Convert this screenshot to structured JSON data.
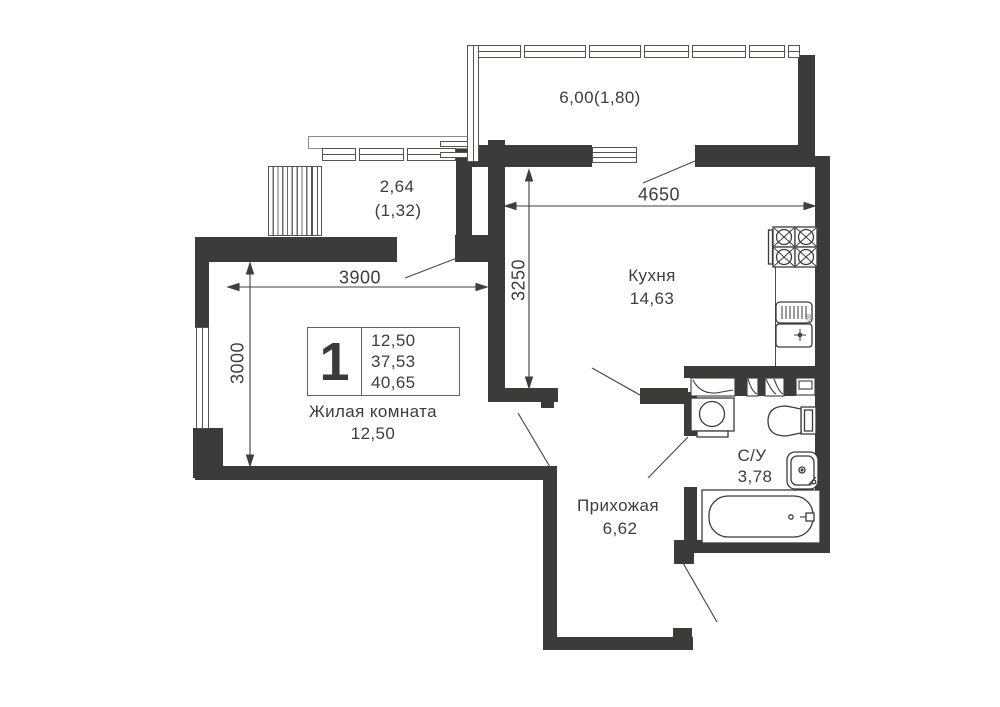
{
  "plan": {
    "balconies": {
      "top_label": "6,00(1,80)",
      "left_line1": "2,64",
      "left_line2": "(1,32)"
    },
    "rooms": {
      "kitchen": {
        "name": "Кухня",
        "area": "14,63"
      },
      "living": {
        "name": "Жилая комната",
        "area": "12,50"
      },
      "hall": {
        "name": "Прихожая",
        "area": "6,62"
      },
      "bathroom": {
        "name": "С/У",
        "area": "3,78"
      }
    },
    "dimensions": {
      "kitchen_width": "4650",
      "kitchen_depth": "3250",
      "living_width": "3900",
      "living_depth": "3000",
      "counter_depth": "600"
    },
    "legend": {
      "rooms_count": "1",
      "living_area": "12,50",
      "reduced_area": "37,53",
      "total_area": "40,65"
    },
    "colors": {
      "wall": "#3b3b39",
      "line": "#55554f",
      "text": "#3d3d3b"
    }
  }
}
